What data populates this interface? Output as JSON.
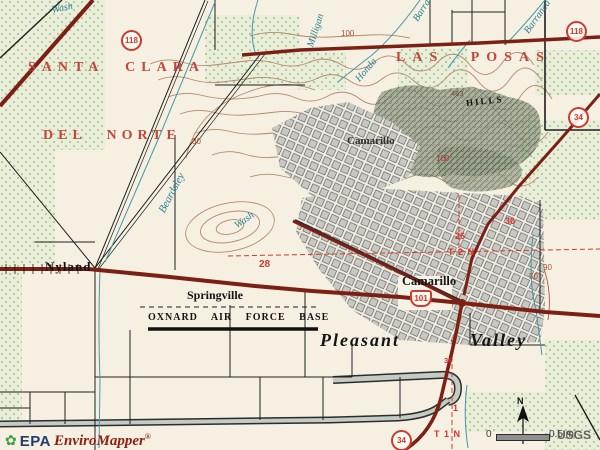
{
  "regions": {
    "santa_clara": "SANTA CLARA",
    "del_norte": "DEL NORTE",
    "las_posas": "LAS POSAS"
  },
  "places": {
    "nyland": "Nyland",
    "springville": "Springville",
    "camarillo": "Camarillo",
    "camarillo_hts": "Camarillo",
    "oxnard_afb": "OXNARD AIR FORCE BASE",
    "pleasant": "Pleasant",
    "valley": "Valley",
    "hills": "HILLS"
  },
  "streams": {
    "wash_nw": "Wash",
    "milligan": "Milligan",
    "honda": "Honda",
    "barranca_a": "Barranca",
    "barranca_b": "Barranca",
    "beardsley": "Beardsley",
    "wash_beardsley": "Wash"
  },
  "contours": {
    "c100": "100",
    "c80": "80",
    "c90": "90",
    "c50": "50",
    "c100b": "100",
    "spot": "463"
  },
  "plss": {
    "s28": "28",
    "s26": "26",
    "s30": "30",
    "t2n": "T 2 N",
    "s36": "36",
    "s1": "1",
    "t1n": "T 1 N"
  },
  "shields": {
    "sr118_w": "118",
    "sr118_e": "118",
    "sr34_e": "34",
    "sr34_s": "34",
    "us101": "101"
  },
  "attribution": {
    "epa": "EPA",
    "product": "EnviroMapper",
    "reg": "®"
  },
  "scalebar": {
    "zero": "0",
    "half": "0.5 mi",
    "usgs": "USGS"
  },
  "north": {
    "n": "N"
  },
  "colors": {
    "background": "#f5f0e1",
    "region_red": "#c0473a",
    "highway_maroon": "#7c2016",
    "stream_teal": "#3f9aa8",
    "contour_brown": "#b5896b",
    "orchard_green": "#e9eeda",
    "urban_gray": "#c7c7c3",
    "plss_red": "#d0372e"
  }
}
